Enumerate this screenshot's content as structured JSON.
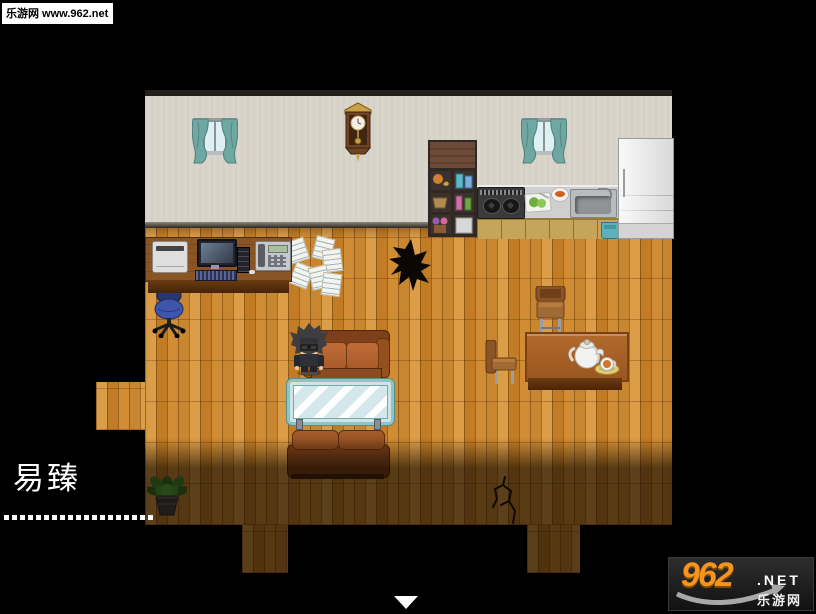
{
  "watermark": {
    "badge_text": "乐游网 www.962.net"
  },
  "dialogue": {
    "speaker_name": "易臻",
    "ellipsis_line": "...................."
  },
  "site_logo": {
    "number": "962",
    "tld": ".NET",
    "site_name": "乐游网"
  },
  "scene": {
    "objects": [
      "curtained window",
      "pendulum wall clock",
      "curtained window",
      "storage shelf",
      "gas stove",
      "cutting board",
      "food bowl",
      "kitchen sink",
      "refrigerator",
      "office desk",
      "printer",
      "computer monitor",
      "keyboard",
      "pc tower",
      "fax phone",
      "scattered papers",
      "office chair",
      "hole in floor",
      "leather sofa",
      "player character",
      "glass coffee table",
      "leather sofa back",
      "wooden chair",
      "wooden chair",
      "dining table",
      "teapot",
      "teacup",
      "potted plant",
      "floor crack"
    ]
  },
  "colors": {
    "page_background": "#000000",
    "wall": "#d9d5ca",
    "floor_wood": "#cf8c35",
    "curtain_teal": "#6fa8a2",
    "logo_orange": "#f7941d",
    "text_white": "#ffffff"
  }
}
